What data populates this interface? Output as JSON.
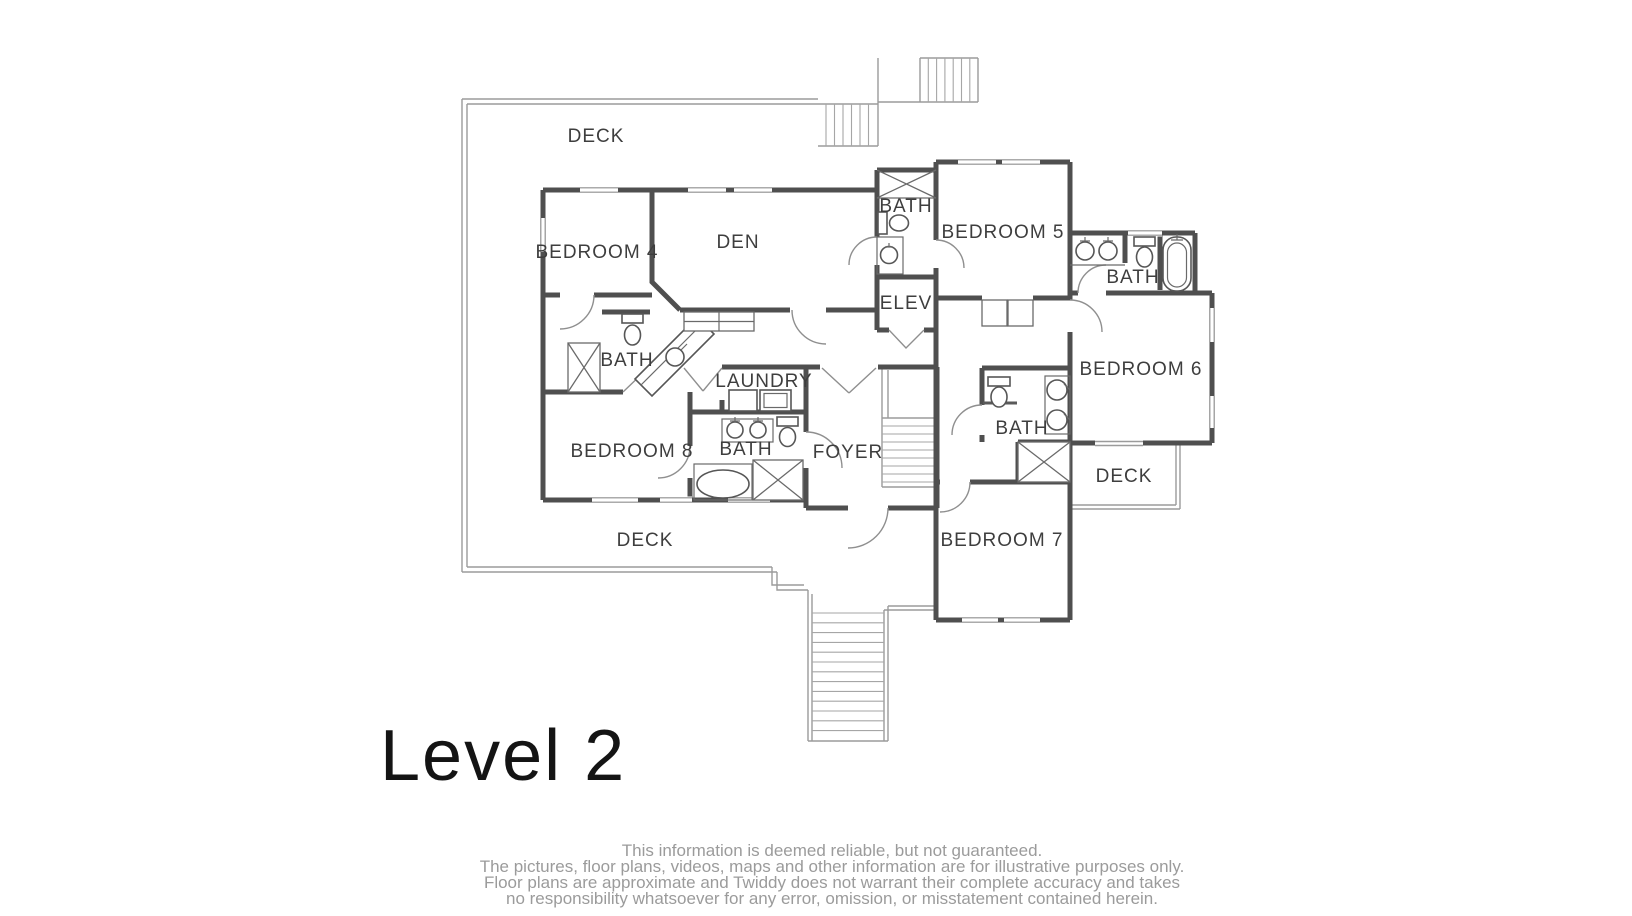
{
  "title": "Level 2",
  "rooms": {
    "deck_top": "DECK",
    "bedroom4": "BEDROOM 4",
    "den": "DEN",
    "bath_b4": "BATH",
    "bedroom8": "BEDROOM 8",
    "laundry": "LAUNDRY",
    "bath_b8": "BATH",
    "foyer": "FOYER",
    "deck_bottom": "DECK",
    "bath_elev": "BATH",
    "elev": "ELEV",
    "bedroom5": "BEDROOM 5",
    "bath_b6": "BATH",
    "bedroom6": "BEDROOM 6",
    "bath_b7": "BATH",
    "bedroom7": "BEDROOM 7",
    "deck_right": "DECK"
  },
  "disclaimer": {
    "lines": [
      "This information is deemed reliable, but not guaranteed.",
      "The pictures, floor plans, videos, maps and other information are for illustrative purposes only.",
      "Floor plans are approximate and Twiddy does not warrant their complete accuracy and takes",
      "no responsibility whatsoever for any error, omission, or misstatement contained herein."
    ]
  },
  "colors": {
    "wall": "#4f4f4f",
    "deck_line": "#9b9b9b",
    "label": "#3e3e3e",
    "title": "#141414",
    "disclaimer_text": "#9b9b9b",
    "background": "#ffffff"
  }
}
